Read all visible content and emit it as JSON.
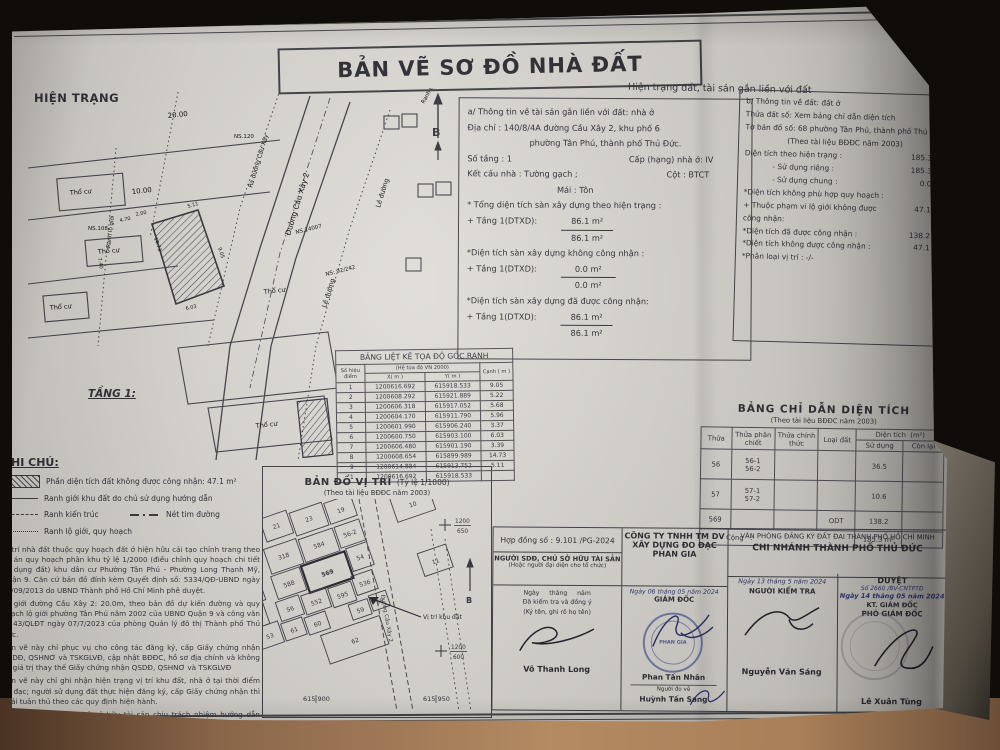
{
  "photo": {
    "paper_color": "#d8d5d0",
    "background_color": "#0f0c09",
    "table_wood_color": "#b38a62",
    "ink_color": "#26262b",
    "stamp_blue": "#3f4b8f"
  },
  "doc": {
    "title": "BẢN VẼ SƠ ĐỒ NHÀ ĐẤT",
    "header_right": "Hiện trạng đất, tài sản gắn liền với đất"
  },
  "site_plan": {
    "label": "HIỆN TRẠNG",
    "floor_label": "TẦNG 1:",
    "north": "B",
    "dim_20": "20.00",
    "dim_10": "10.00",
    "road_cau_xay_2": "Đường Cầu Xây 2",
    "road_ra_duong": "Ra đường Cầu Xây",
    "road_le_duong": "Lề đường",
    "road_ranh_lo_gioi": "Ranh lộ giới",
    "parcel_tho_cu": "Thổ cư",
    "ns_108": "NS.108",
    "ns_120": "NS.120",
    "ns_14007": "NS.14007",
    "ns_92_242": "NS: 92/242",
    "dims": [
      "5.11",
      "9.05",
      "3.37",
      "6.03",
      "14.73",
      "5.96",
      "7.40",
      "2.00",
      "4.70"
    ]
  },
  "info_a": {
    "line1": "a/ Thông tin về tài sản gắn liền với đất: nhà ở",
    "line2": "Địa chỉ : 140/8/4A đường Cầu Xây 2, khu phố 6",
    "line3": "phường Tân Phú, thành phố Thủ Đức.",
    "line4a": "Số tầng : 1",
    "line4b": "Cấp (hạng) nhà ở: IV",
    "line5a": "Kết cấu nhà : Tường gạch ;",
    "line5b": "Cột : BTCT",
    "line6": "Mái : Tôn",
    "line7": "* Tổng diện tích sàn xây dựng theo hiện trạng :",
    "line8_label": "+ Tầng 1(DTXD):",
    "line8_num": "86.1 m²",
    "line8_den": "86.1 m²",
    "line9": "*Diện tích sàn xây dựng không công nhận :",
    "line10_label": "+ Tầng 1(DTXD):",
    "line10_num": "0.0 m²",
    "line10_den": "0.0 m²",
    "line11": "*Diện tích sàn xây dựng đã được công nhận:",
    "line12_label": "+ Tầng 1(DTXD):",
    "line12_num": "86.1 m²",
    "line12_den": "86.1 m²"
  },
  "info_b": {
    "line1": "b/ Thông tin về đất: đất ở",
    "line2": "Thửa đất số: Xem bảng chỉ dẫn diện tích",
    "line3": "Tờ bản đồ số: 68 phường Tân Phú, thành phố Thủ Đức",
    "line4": "(Theo tài liệu BĐĐC năm 2003)",
    "line5_label": "Diện tích theo hiện trạng :",
    "line5_val": "185.3 m²",
    "line6_label": "- Sử dụng riêng :",
    "line6_val": "185.3 m²",
    "line7_label": "- Sử dụng chung :",
    "line7_val": "0.0 m²",
    "line8": "*Diện tích không phù hợp quy hoạch :",
    "line9_label": "+ Thuộc phạm vi lộ giới không được công nhận:",
    "line9_val": "47.1 m²",
    "line10_label": "*Diện tích đã được công nhận :",
    "line10_val": "138.2 m²",
    "line11_label": "*Diện tích không được công nhận :",
    "line11_val": "47.1 m²",
    "line12": "*Phân loại vị trí : -/-"
  },
  "coord_table": {
    "title": "BẢNG LIỆT KÊ TỌA ĐỘ GÓC RANH",
    "col_point": "Số hiệu điểm",
    "col_group": "(Hệ tọa độ VN 2000)",
    "col_x": "X( m )",
    "col_y": "Y( m )",
    "col_edge": "Cạnh ( m )",
    "rows": [
      {
        "p": "1",
        "x": "1200616.692",
        "y": "615918.533",
        "c": "9.05"
      },
      {
        "p": "2",
        "x": "1200608.292",
        "y": "615921.889",
        "c": "5.22"
      },
      {
        "p": "3",
        "x": "1200606.318",
        "y": "615917.052",
        "c": "5.68"
      },
      {
        "p": "4",
        "x": "1200604.170",
        "y": "615911.790",
        "c": "5.96"
      },
      {
        "p": "5",
        "x": "1200601.990",
        "y": "615906.240",
        "c": "3.37"
      },
      {
        "p": "6",
        "x": "1200600.750",
        "y": "615903.100",
        "c": "6.03"
      },
      {
        "p": "7",
        "x": "1200606.480",
        "y": "615901.190",
        "c": "3.39"
      },
      {
        "p": "8",
        "x": "1200608.654",
        "y": "615899.989",
        "c": "14.73"
      },
      {
        "p": "9",
        "x": "1200614.884",
        "y": "615913.752",
        "c": "5.11"
      },
      {
        "p": "1",
        "x": "1200616.692",
        "y": "615918.533",
        "c": ""
      }
    ]
  },
  "notes": {
    "heading": "GHI CHÚ:",
    "legend_hatch": "Phần diện tích đất không được công nhận: 47.1 m²",
    "legend_solid": "Ranh giới khu đất do chủ sử dụng hướng dẫn",
    "legend_dashed": "Ranh kiến trúc",
    "legend_dashdot": "Nét tim đường",
    "legend_dotted": "Ranh lộ giới, quy hoạch",
    "para1": "Vị trí nhà đất thuộc quy hoạch đất ở hiện hữu cải tạo chỉnh trang theo đồ án quy hoạch phân khu tỷ lệ 1/2000 (điều chỉnh quy hoạch chi tiết sử dụng đất) khu dân cư Phường Tân Phú - Phường Long Thạnh Mỹ, Quận 9. Căn cứ bản đồ đính kèm Quyết định số: 5334/QĐ-UBND ngày 26/09/2013 do UBND Thành phố Hồ Chí Minh phê duyệt.",
    "para2": "Lộ giới đường Cầu Xây 2: 20.0m, theo bản đồ dự kiến đường và quy hoạch lộ giới phường Tân Phú năm 2002 của UBND Quận 9 và công văn số 43/QLĐT ngày 07/7/2023 của phòng Quản lý đô thị Thành phố Thủ Đức.",
    "para3": "Bản vẽ này chỉ phục vụ cho công tác đăng ký, cấp Giấy chứng nhận QSDĐ, QSHNƠ và TSKGLVĐ, cập nhật BĐĐC, hồ sơ địa chính và không có giá trị thay thế Giấy chứng nhận QSDĐ, QSHNƠ và TSKGLVĐ",
    "para4": "Bản vẽ này chỉ ghi nhận hiện trạng vị trí khu đất, nhà ở tại thời điểm đo đạc; người sử dụng đất thực hiện đăng ký, cấp Giấy chứng nhận thì phải tuân thủ theo các quy định hiện hành.",
    "para5": "Người sử dụng đất, chủ sở hữu tài sản chịu trách nhiệm hướng dẫn ranh, tổ chức đo vẽ chịu trách nhiệm về kỹ thuật và đúng hiện trạng."
  },
  "location_map": {
    "title": "BẢN ĐỒ VỊ TRÍ",
    "scale": "(Tỷ lệ 1/1000)",
    "subtitle": "(Theo tài liệu BĐĐC năm 2003)",
    "marker_label": "Vị trí khu đất",
    "north": "B",
    "cross_1_top": "1200",
    "cross_1_bottom": "650",
    "cross_2_top": "1200",
    "cross_2_bottom": "600",
    "coord_left": "615 900",
    "coord_right": "615 950",
    "parcels": [
      "21",
      "23",
      "19",
      "318",
      "584",
      "56-2",
      "588",
      "569",
      "54",
      "25",
      "56",
      "552",
      "595",
      "536",
      "59",
      "58",
      "60",
      "61",
      "53",
      "379",
      "378",
      "6022",
      "62",
      "10",
      "11",
      "9"
    ]
  },
  "area_table": {
    "title": "BẢNG CHỈ DẪN DIỆN TÍCH",
    "subtitle": "(Theo tài liệu BĐĐC năm 2003)",
    "col_thua": "Thửa",
    "col_phan_chiet": "Thửa phân chiết",
    "col_chinh_thuc": "Thửa chính thức",
    "col_loai_dat": "Loại đất",
    "col_dien_tich": "Diện tích",
    "col_dien_tich_unit": "(m²)",
    "col_su_dung": "Sử dụng",
    "col_con_lai": "Còn lại",
    "rows": [
      {
        "thua": "56",
        "pc1": "56-1",
        "pc2": "56-2",
        "ct": "",
        "ld": "",
        "sd": "36.5",
        "cl": ""
      },
      {
        "thua": "57",
        "pc1": "57-1",
        "pc2": "57-2",
        "ct": "",
        "ld": "",
        "sd": "10.6",
        "cl": ""
      },
      {
        "thua": "569",
        "pc1": "",
        "pc2": "",
        "ct": "",
        "ld": "ODT",
        "sd": "138.2",
        "cl": ""
      }
    ],
    "total_label": "Cộng   :",
    "total_value": "185.3 m²"
  },
  "signatures": {
    "contract": "Hợp đồng số : 9.101 /PG-2024",
    "owner_title": "NGƯỜI SDĐ, CHỦ SỞ HỮU TÀI SẢN",
    "owner_sub": "(Hoặc người đại diện cho tổ chức)",
    "owner_date": "Ngày     tháng     năm",
    "owner_line2": "Đã kiểm tra và đồng ý",
    "owner_line3": "(Ký tên, ghi rõ họ tên)",
    "owner_name": "Võ Thanh Long",
    "company_line1": "CÔNG TY TNHH TM DV",
    "company_line2": "XÂY DỰNG ĐO ĐẠC",
    "company_line3": "PHAN GIA",
    "company_date": "Ngày 06 tháng 05 năm 2024",
    "company_role": "GIÁM ĐỐC",
    "company_name": "Phan Tấn Nhân",
    "surveyor_role": "Người đo vẽ",
    "surveyor_name": "Huỳnh Tấn Sang",
    "office_line1": "VĂN PHÒNG ĐĂNG KÝ ĐẤT ĐAI THÀNH PHỐ HỒ CHÍ MINH",
    "office_line2": "CHI NHÁNH THÀNH PHỐ THỦ ĐỨC",
    "checker_date": "Ngày 13 tháng 5 năm 2024",
    "checker_role": "NGƯỜI KIỂM TRA",
    "checker_name": "Nguyễn Văn Sáng",
    "approve_label": "DUYỆT",
    "approve_number": "Số 2660 /BV-CNTPTĐ",
    "approve_date": "Ngày 14 tháng 05 năm 2024",
    "approve_role1": "KT. GIÁM ĐỐC",
    "approve_role2": "PHÓ GIÁM ĐỐC",
    "approve_name": "Lê Xuân Tùng",
    "stamp_label": "PHAN GIA"
  }
}
